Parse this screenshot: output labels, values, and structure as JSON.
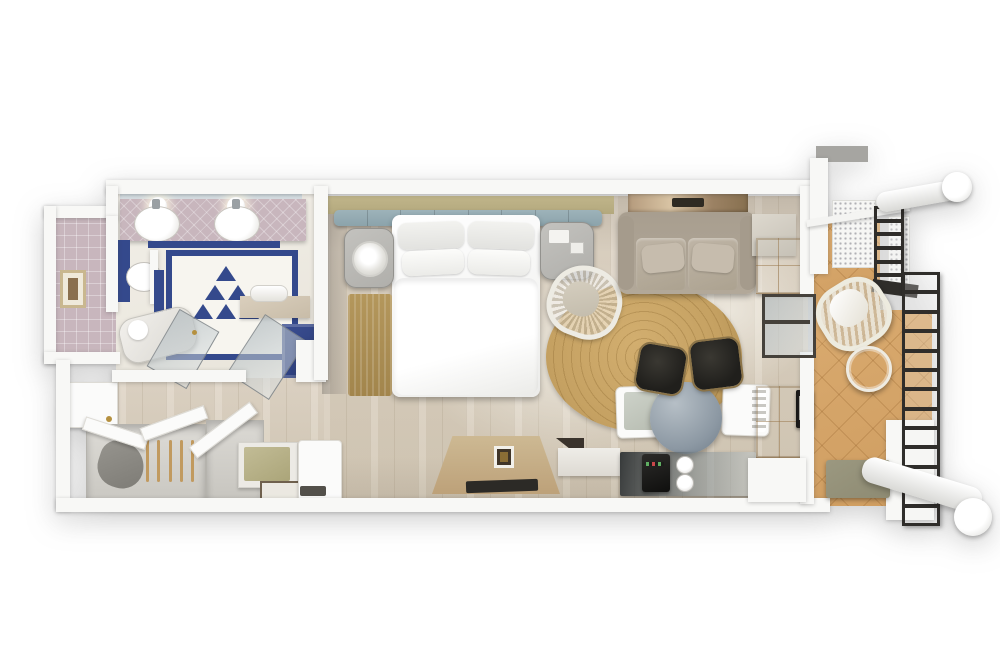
{
  "meta": {
    "kind": "3d-floorplan-render",
    "description": "Top-down 3D rendering of a furnished hotel guest room: entry vestibule, bathroom with mosaic tile floor, bedroom with king bed, living area, coffee bar and furnished balcony with railing",
    "visible_text": ""
  },
  "palette": {
    "wall": "#f8f8f6",
    "wood": "#ded4c5",
    "wood_dark": "#d2c7b4",
    "balcony_tile": "#d9aa6f",
    "ivory": "#f2efe8",
    "mauve": "#c8b6bd",
    "blue": "#34498c",
    "khaki": "#b3a87d",
    "teal": "#8ba3ab",
    "taupe": "#b2a899",
    "darkwood": "#33241a",
    "black": "#201f1c",
    "jute": "#c5a162",
    "gray_furn": "#b0afab",
    "table_gray": "#8c98a3",
    "white_furn": "#fbfbfa",
    "rail": "#2f2d2a",
    "olive": "#8e8b73"
  },
  "rooms": {
    "entry": {
      "label": "entry-vestibule",
      "items": [
        "entry-door",
        "framed-art",
        "closet-open-doors",
        "hangers",
        "wardrobe",
        "luggage-bench",
        "door-mat"
      ]
    },
    "bathroom": {
      "label": "bathroom",
      "items": [
        "mirror",
        "globe-lights",
        "double-vanity",
        "sinks",
        "toilet",
        "bathtub",
        "frosted-glass-doors",
        "towel-bench",
        "shower",
        "blue-mosaic-floor"
      ]
    },
    "bedroom": {
      "label": "bedroom",
      "items": [
        "king-bed",
        "pillows",
        "tufted-headboard",
        "nightstands",
        "table-lamp",
        "bedside-rug",
        "rattan-armchair",
        "round-jute-rug",
        "desk",
        "white-cabinet"
      ]
    },
    "living": {
      "label": "living-area",
      "items": [
        "sofa",
        "wall-art",
        "ottomans",
        "armoire",
        "dresser",
        "mini-fridge",
        "sliding-glass-door",
        "coffee-bar",
        "coffee-maker",
        "cups",
        "round-table",
        "dining-chairs"
      ]
    },
    "balcony": {
      "label": "balcony-lanai",
      "items": [
        "privacy-screens",
        "metal-railing",
        "wicker-lounge-chair",
        "wire-side-table",
        "bench",
        "structural-beams"
      ]
    }
  },
  "counts": {
    "railing_upper_rungs": 5,
    "railing_lower_rungs": 12,
    "hangers": 5,
    "headboard_tufts": 7,
    "mosaic": {
      "r1": 1,
      "r2": 2,
      "r3": 3
    }
  }
}
